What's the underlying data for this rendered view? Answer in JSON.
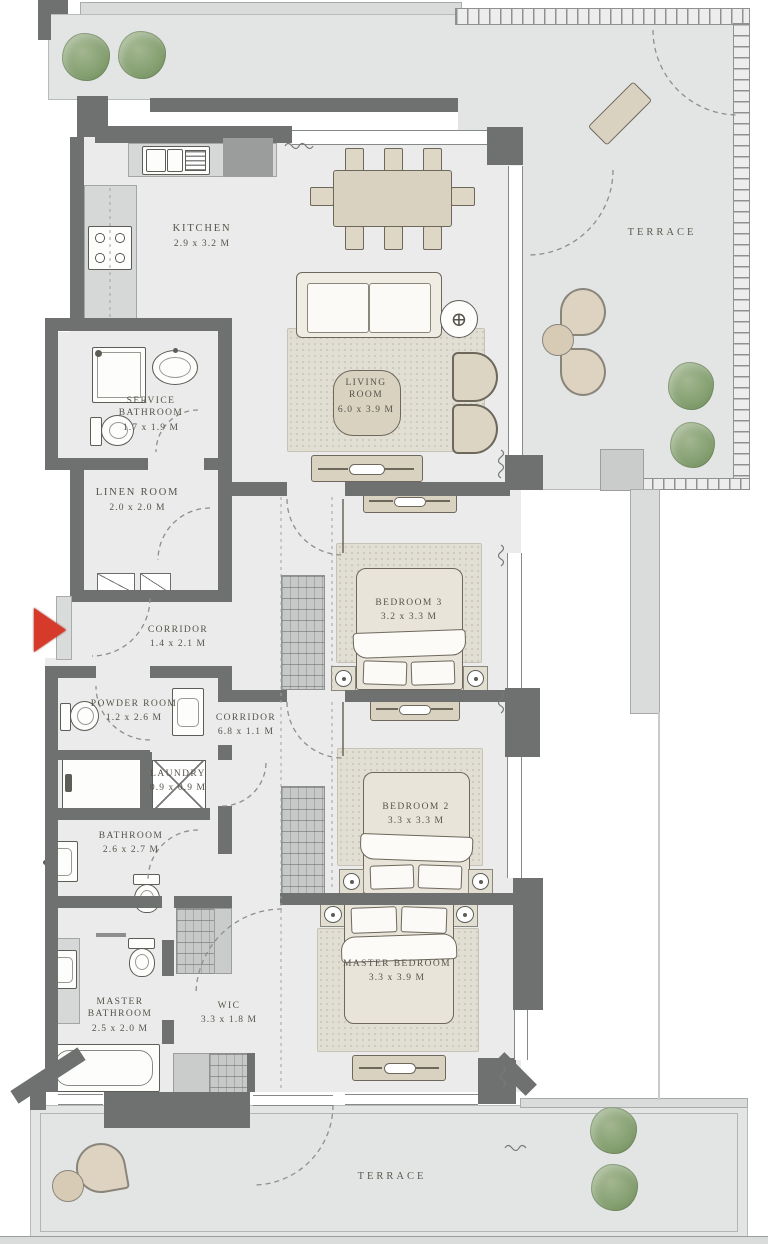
{
  "plan": {
    "title": "3-bedroom apartment floor plan",
    "rooms": [
      {
        "name": "KITCHEN",
        "dims": "2.9 x 3.2 M"
      },
      {
        "name": "TERRACE",
        "dims": ""
      },
      {
        "name": "LIVING ROOM",
        "dims": "6.0 x 3.9 M"
      },
      {
        "name": "SERVICE BATHROOM",
        "dims": "1.7 x 1.9 M"
      },
      {
        "name": "LINEN ROOM",
        "dims": "2.0 x 2.0 M"
      },
      {
        "name": "CORRIDOR",
        "dims": "1.4 x 2.1 M"
      },
      {
        "name": "POWDER ROOM",
        "dims": "1.2 x 2.6 M"
      },
      {
        "name": "CORRIDOR",
        "dims": "6.8 x 1.1 M"
      },
      {
        "name": "BEDROOM 3",
        "dims": "3.2 x 3.3 M"
      },
      {
        "name": "LAUNDRY",
        "dims": "0.9 x 0.9 M"
      },
      {
        "name": "BATHROOM",
        "dims": "2.6 x 2.7 M"
      },
      {
        "name": "BEDROOM 2",
        "dims": "3.3 x 3.3 M"
      },
      {
        "name": "MASTER BATHROOM",
        "dims": "2.5 x 2.0 M"
      },
      {
        "name": "WIC",
        "dims": "3.3 x 1.8 M"
      },
      {
        "name": "MASTER BEDROOM",
        "dims": "3.3 x 3.9 M"
      },
      {
        "name": "TERRACE",
        "dims": ""
      }
    ],
    "entry_marker": {
      "type": "red-arrow",
      "direction": "right"
    },
    "icons": {
      "side_table_crosshair": "⊕"
    },
    "colors": {
      "wall": "#6f7070",
      "interior_floor": "#eaebea",
      "terrace_floor": "#e3e5e4",
      "furniture": "#d9d2c0",
      "rug": "#e1ded3",
      "plant": "#87a173",
      "entry_arrow": "#d63a2a"
    }
  }
}
